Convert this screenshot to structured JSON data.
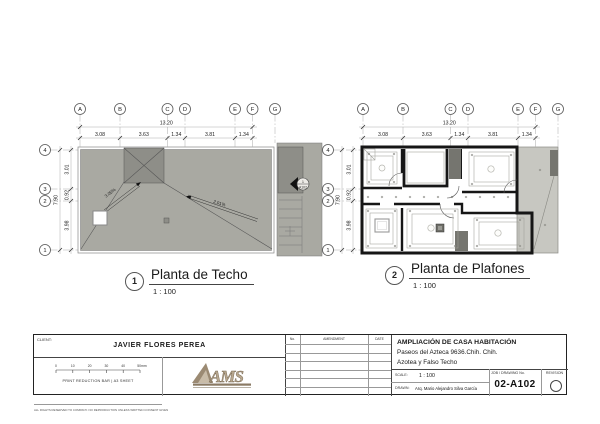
{
  "plans": {
    "grid_cols": [
      "A",
      "B",
      "C",
      "D",
      "E",
      "F",
      "G"
    ],
    "grid_rows": [
      "4",
      "3",
      "2",
      "1"
    ],
    "dim_total_w": "13.20",
    "dim_cols": [
      "3.08",
      "3.63",
      "1.34",
      "3.81",
      "1.34"
    ],
    "dim_total_h": "7.90",
    "dim_rows": [
      "3.01",
      "0.92",
      "3.98"
    ],
    "plan1": {
      "num": "1",
      "title": "Planta de Techo",
      "scale": "1 : 100",
      "slope_a": "3.05%",
      "slope_b": "2.01%",
      "callout_top": "1",
      "callout_bottom": "A102"
    },
    "plan2": {
      "num": "2",
      "title": "Planta de Plafones",
      "scale": "1 : 100"
    }
  },
  "titleblock": {
    "client_label": "CLIENT:",
    "client_name": "JAVIER FLORES PEREA",
    "bar_ticks": [
      "0",
      "10",
      "20",
      "30",
      "40",
      "50mm"
    ],
    "bar_label": "PRINT REDUCTION BAR | A3 SHEET",
    "rights": "ALL RIGHTS RESERVED TO COMPANY. NO REPRODUCTION UNLESS WRITTEN CONSENT GIVEN",
    "logo": "AMS",
    "rev_no": "No.",
    "rev_amendment": "AMENDMENT",
    "rev_date": "DATE",
    "project_line1": "AMPLIACIÓN DE CASA HABITACIÓN",
    "project_line2": "Paseos del Azteca 9636.Chih. Chih.",
    "project_line3": "Azotea y Falso Techo",
    "scale_label": "SCALE:",
    "scale_value": "1 : 100",
    "drawn_label": "DRAWN:",
    "drawn_value": "Arq. Mario Alejandro Silva García",
    "job_label": "JOB / DRAWING No.",
    "job_value": "02-A102",
    "revision_label": "REVISION"
  },
  "colors": {
    "roof_gray": "#a9a9a2",
    "dark_gray": "#8e8e88",
    "ceiling": "#eaeae5",
    "terrace": "#c7c7c1",
    "wall": "#161616",
    "logo_tan": "#a8957c"
  }
}
